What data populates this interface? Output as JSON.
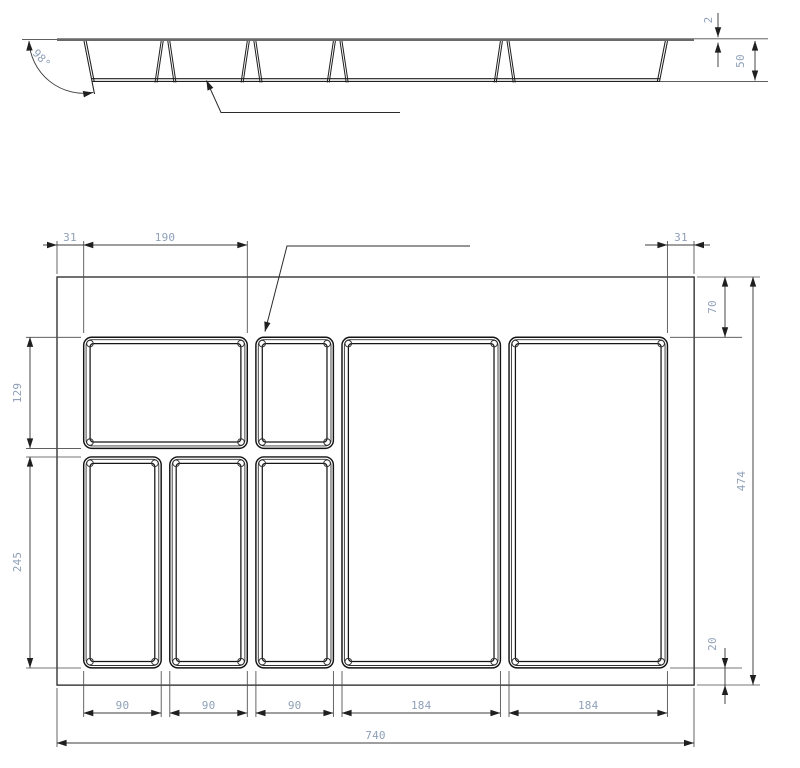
{
  "drawing": {
    "type": "technical-drawing-cutlery-tray-insert",
    "section_view": {
      "dims": {
        "wall_angle": "98°",
        "flange_thickness": "2",
        "height": "50"
      },
      "geometry_mm": {
        "height": 50,
        "flange_thickness": 2,
        "divider_positions": [
          126,
          226,
          326,
          520
        ],
        "left_wall": 31,
        "right_wall": 709
      }
    },
    "plan_view": {
      "dims": {
        "top": {
          "left_margin": "31",
          "first_compartment_width": "190",
          "right_margin": "31"
        },
        "left": {
          "upper_row_depth": "129",
          "lower_row_depth": "245"
        },
        "right": {
          "top_margin": "70",
          "overall_depth": "474",
          "bottom_margin": "20"
        },
        "bottom": {
          "column_widths": [
            "90",
            "90",
            "90",
            "184",
            "184"
          ],
          "overall_width": "740"
        }
      },
      "geometry_mm": {
        "tray": {
          "w": 740,
          "h": 474
        },
        "compartments": [
          {
            "x": 31,
            "y": 70,
            "w": 190,
            "h": 129
          },
          {
            "x": 231,
            "y": 70,
            "w": 90,
            "h": 129
          },
          {
            "x": 31,
            "y": 209,
            "w": 90,
            "h": 245
          },
          {
            "x": 131,
            "y": 209,
            "w": 90,
            "h": 245
          },
          {
            "x": 231,
            "y": 209,
            "w": 90,
            "h": 245
          },
          {
            "x": 331,
            "y": 70,
            "w": 184,
            "h": 384
          },
          {
            "x": 525,
            "y": 70,
            "w": 184,
            "h": 384
          }
        ]
      }
    }
  }
}
